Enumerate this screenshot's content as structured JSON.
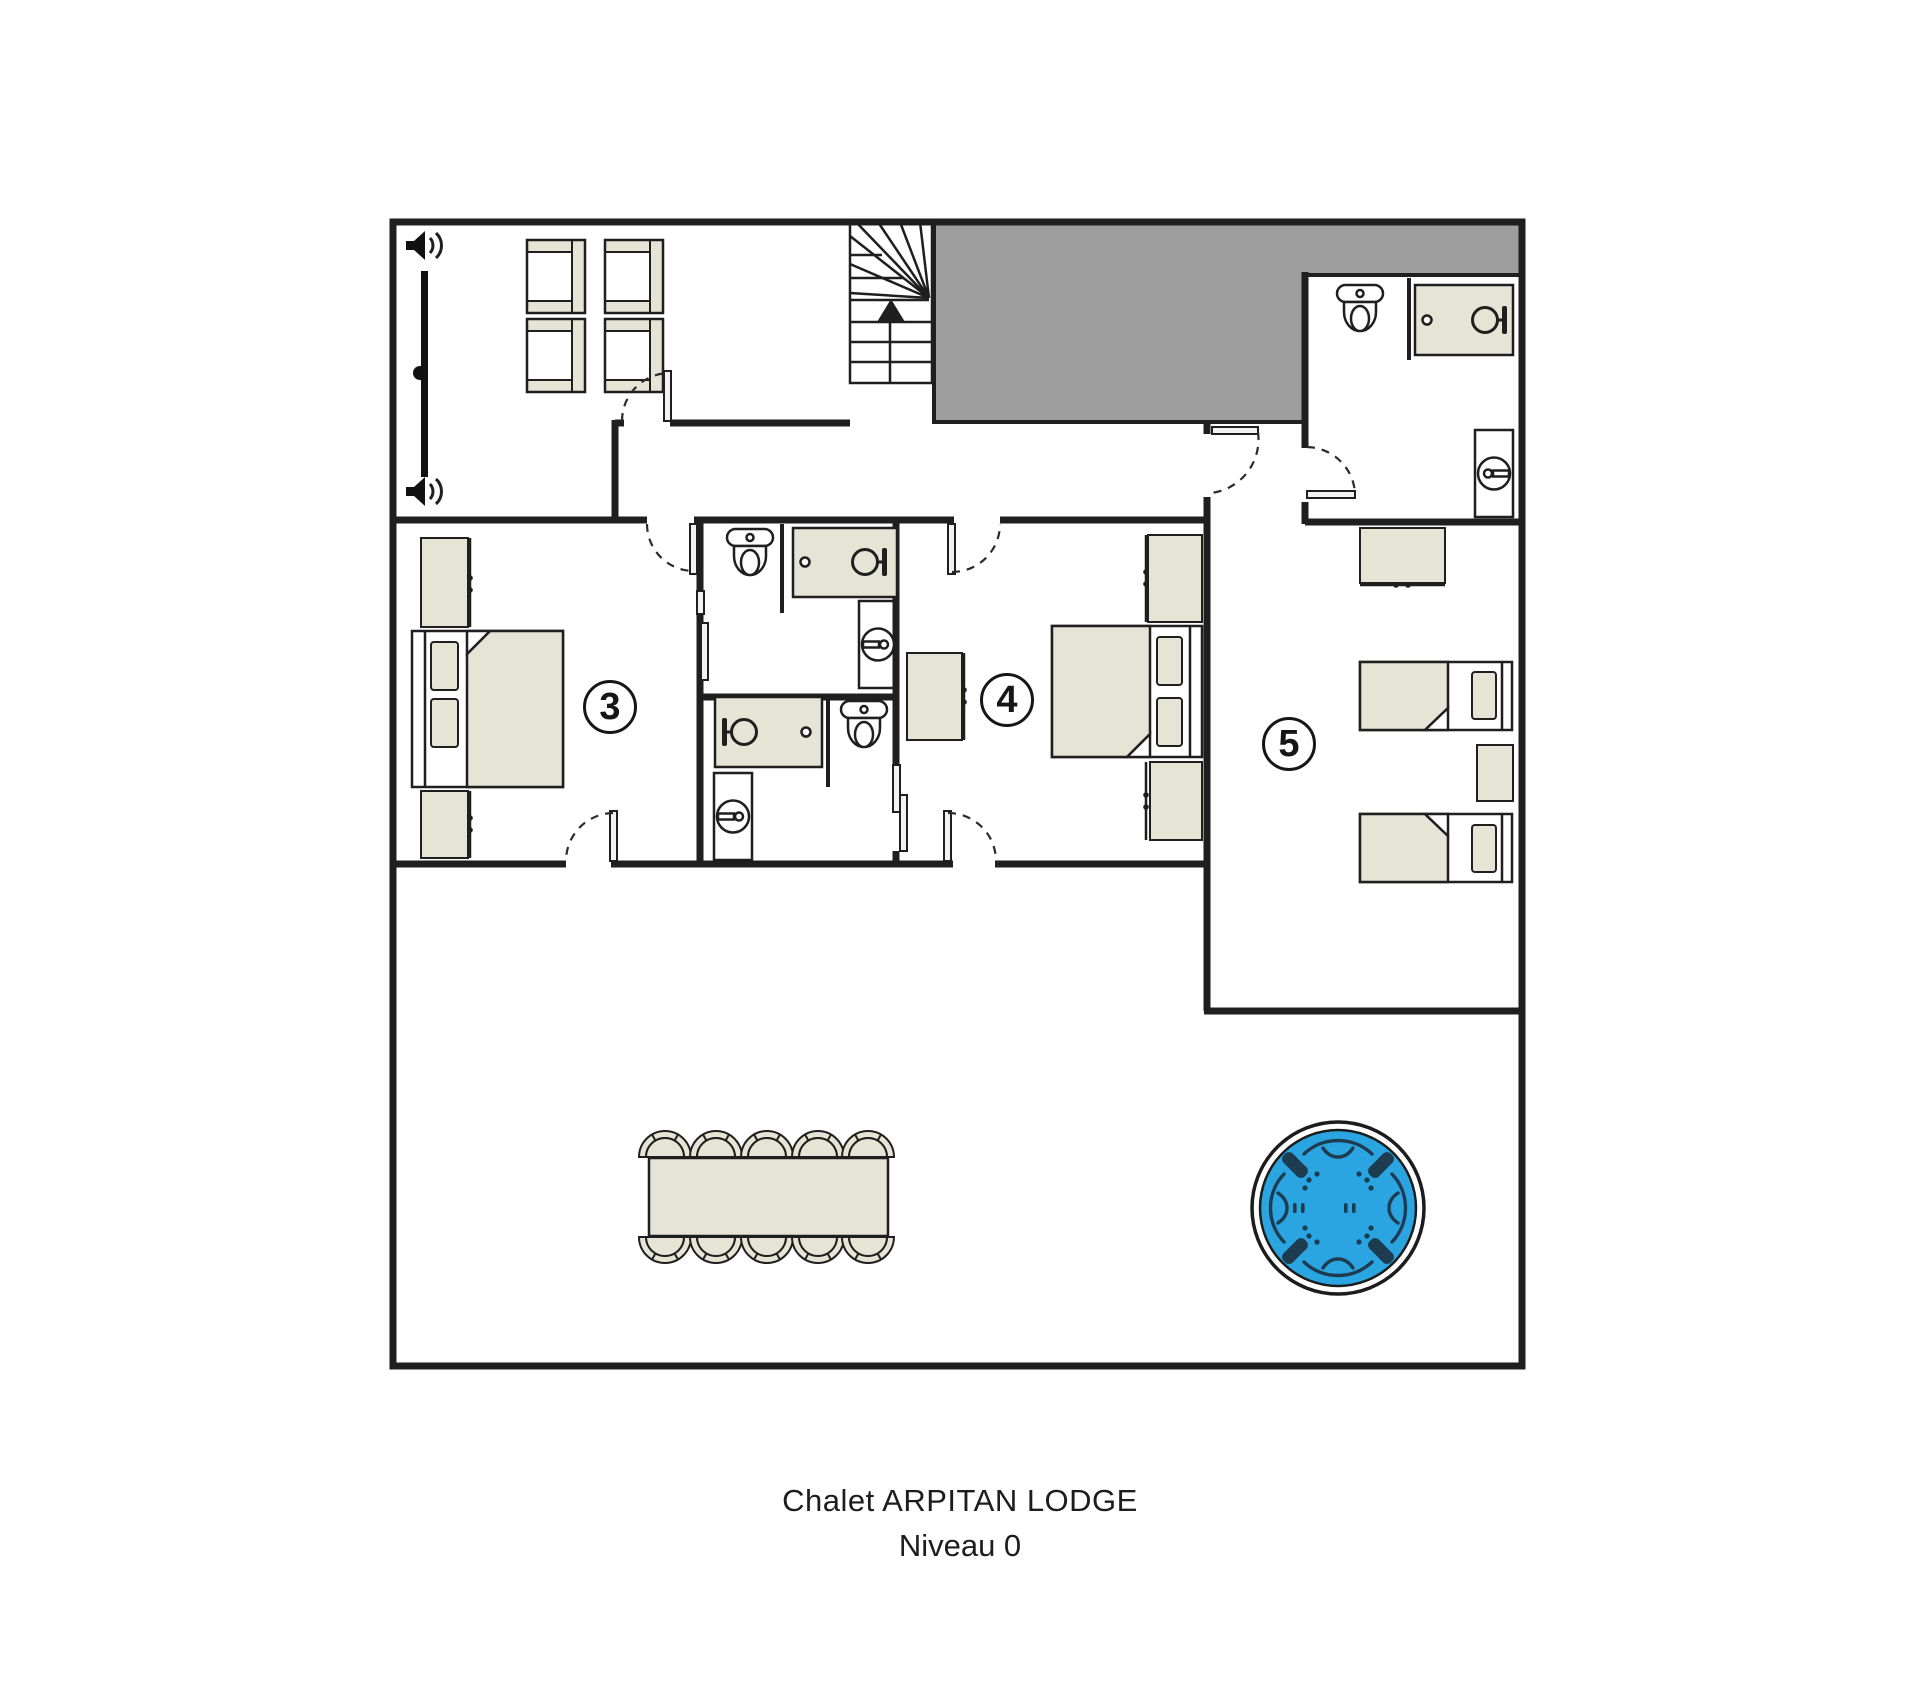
{
  "title": {
    "line1": "Chalet ARPITAN LODGE",
    "line2": "Niveau 0"
  },
  "room_labels": {
    "bedroom_3": "3",
    "bedroom_4": "4",
    "bedroom_5": "5"
  },
  "colors": {
    "wall": "#1f1f1f",
    "furniture_fill": "#e5e4d5",
    "void_fill": "#9e9e9e",
    "hot_tub_water": "#2aa5e2",
    "hot_tub_detail": "#1d3c50",
    "paper": "#ffffff"
  },
  "icons": {
    "top_left_wall": [
      "speaker-icon",
      "speaker-icon"
    ],
    "staircase": "up-arrow-icon",
    "legend": [
      "toilet-icon",
      "shower-icon",
      "bathtub-icon",
      "washbasin-icon"
    ]
  }
}
